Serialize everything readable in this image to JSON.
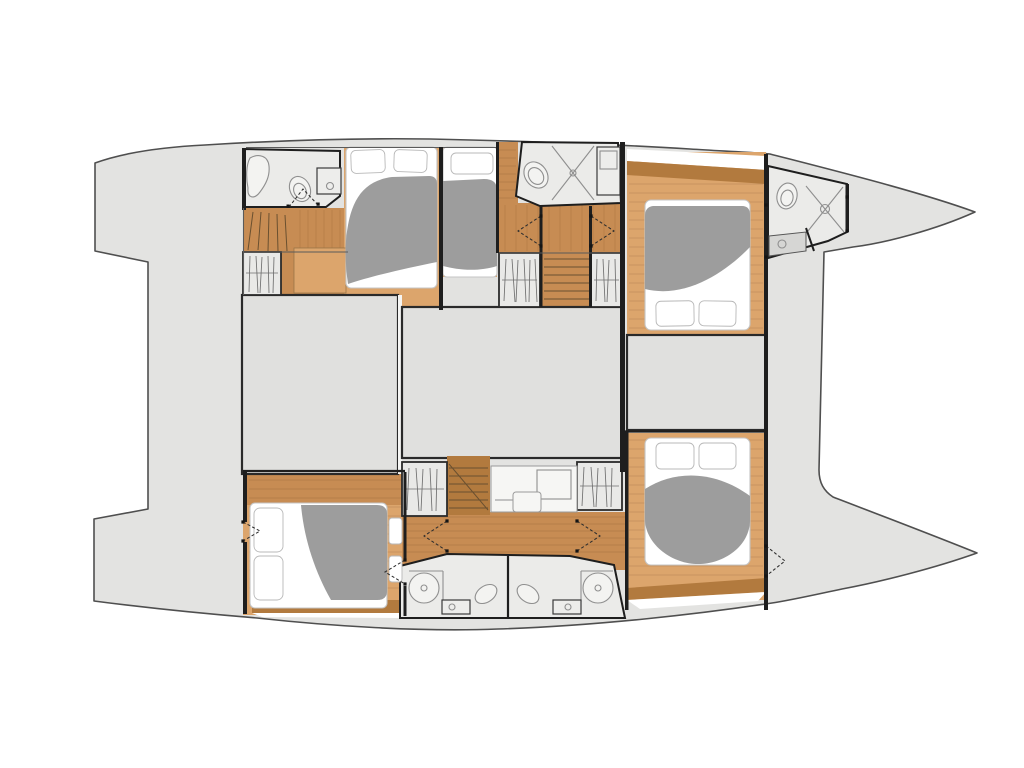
{
  "plan": {
    "vessel_type": "catamaran",
    "view": "overhead-accommodation-deck-plan",
    "bow_direction": "right",
    "berths": 5,
    "bathrooms": 5,
    "wardrobes": 5,
    "staircases": 3,
    "desks": 1,
    "rooms": [
      "port-aft-bathroom",
      "port-companionway-stairs",
      "port-aft-wardrobe",
      "port-guest-cabin-1",
      "port-guest-cabin-2",
      "port-mid-bathroom",
      "port-mid-stairs",
      "port-wardrobe-a",
      "port-wardrobe-b",
      "port-forward-cabin",
      "bow-bathroom",
      "saloon-block-left",
      "saloon-block-center",
      "saloon-block-right",
      "starboard-aft-cabin",
      "starboard-wardrobe-c",
      "starboard-companionway-stairs",
      "vanity-desk",
      "starboard-wardrobe-d",
      "starboard-corridor",
      "starboard-bathroom-left",
      "starboard-bathroom-right",
      "starboard-forward-cabin"
    ],
    "fixture_icons": [
      "toilet-icon",
      "shower-icon",
      "sink-icon",
      "bed",
      "pillow",
      "hanging-clothes-icon",
      "stairs-icon",
      "desk-icon",
      "door-swing-icon"
    ]
  },
  "colors": {
    "background": "#ffffff",
    "hull": "#e3e3e1",
    "hullStroke": "#4f4f4f",
    "saloonBlock": "#e0e0de",
    "blockStroke": "#2a2a2a",
    "roomFloor": "#ebebe9",
    "wardrobeFill": "#e9e9e7",
    "woodLight": "#dca56c",
    "woodMid": "#c78c53",
    "woodDark": "#b27a3e",
    "wall": "#1e1e1e",
    "fixtureLine": "#8f8f8f",
    "blanket": "#9d9d9d",
    "mattress": "#ffffff",
    "mattressStroke": "#c4c4c4",
    "gapLine": "#f5f5f3",
    "deckCounter": "#d6d6d4",
    "dot": "#141414"
  }
}
